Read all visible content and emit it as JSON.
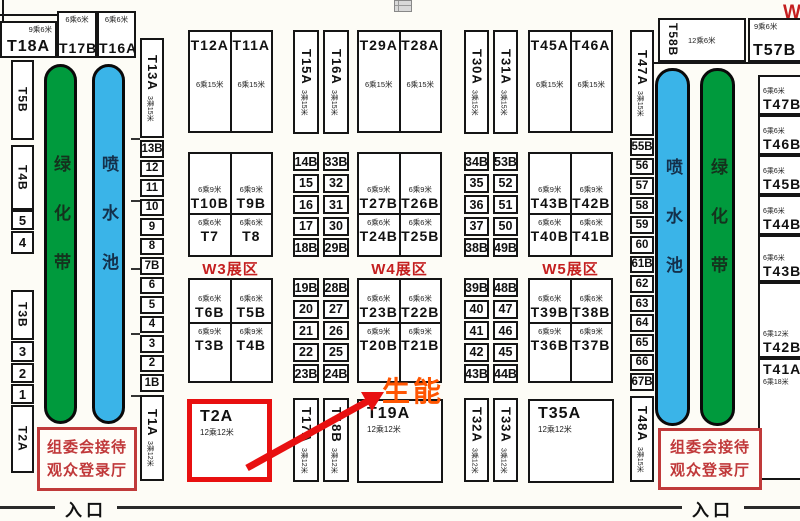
{
  "entrance": "入口",
  "green_belt_label": "绿化带",
  "fountain_label": "喷水池",
  "reception": {
    "line1": "组委会接待",
    "line2": "观众登录厅"
  },
  "annotation": {
    "text": "生能"
  },
  "zone_labels": {
    "w3": "W3展区",
    "w4": "W4展区",
    "w5": "W5展区",
    "w_cut": "W"
  },
  "colors": {
    "green_belt": "#009a3d",
    "fountain_blue": "#3ab4e8",
    "highlight_red": "#e81010",
    "zone_label_red": "#c41f1f",
    "reception_red": "#c03a3a",
    "annotation_orange": "#ff5500"
  },
  "top_left": {
    "t18a": {
      "name": "T18A",
      "size": "9乘6米"
    },
    "t17b": {
      "name": "T17B",
      "size": "6乘6米"
    },
    "t16a": {
      "name": "T16A",
      "size": "6乘6米"
    }
  },
  "left_wall_cells": [
    "T5B",
    "T4B",
    "5",
    "4",
    "T3B",
    "3",
    "2",
    "1",
    "T2A"
  ],
  "inner_left_cells": [
    "13B",
    "12",
    "11",
    "10",
    "9",
    "8",
    "7B",
    "6",
    "5",
    "4",
    "3",
    "2",
    "1B"
  ],
  "inner_right_cells": [
    "55B",
    "56",
    "57",
    "58",
    "59",
    "60",
    "61B",
    "62",
    "63",
    "64",
    "65",
    "66",
    "67B"
  ],
  "strips": {
    "t13a": {
      "name": "T13A",
      "size": "3乘15米"
    },
    "t1a": {
      "name": "T1A",
      "size": "3乘12米"
    },
    "t47a": {
      "name": "T47A",
      "size": "3乘15米"
    },
    "t48a": {
      "name": "T48A",
      "size": "3乘15米"
    },
    "t15a": {
      "name": "T15A",
      "size": "3乘15米"
    },
    "t16a": {
      "name": "T16A",
      "size": "3乘15米"
    },
    "t30a": {
      "name": "T30A",
      "size": "3乘15米"
    },
    "t31a": {
      "name": "T31A",
      "size": "3乘15米"
    },
    "t17a": {
      "name": "T17A",
      "size": "3乘12米"
    },
    "t18b": {
      "name": "T18B",
      "size": "3乘12米"
    },
    "t32a": {
      "name": "T32A",
      "size": "3乘12米"
    },
    "t33a": {
      "name": "T33A",
      "size": "3乘12米"
    }
  },
  "pair_boxes": {
    "w3_top": {
      "left": {
        "name": "T12A",
        "size": "6乘15米"
      },
      "right": {
        "name": "T11A",
        "size": "6乘15米"
      }
    },
    "w4_top": {
      "left": {
        "name": "T29A",
        "size": "6乘15米"
      },
      "right": {
        "name": "T28A",
        "size": "6乘15米"
      }
    },
    "w5_top": {
      "left": {
        "name": "T45A",
        "size": "6乘15米"
      },
      "right": {
        "name": "T46A",
        "size": "6乘15米"
      }
    }
  },
  "quad_boxes": {
    "w3_mid": {
      "tl": {
        "name": "T10B",
        "size": "6乘9米"
      },
      "tr": {
        "name": "T9B",
        "size": "6乘9米"
      },
      "bl": {
        "name": "T7",
        "size": "6乘6米"
      },
      "br": {
        "name": "T8",
        "size": "6乘6米"
      }
    },
    "w3_low": {
      "tl": {
        "name": "T6B",
        "size": "6乘6米"
      },
      "tr": {
        "name": "T5B",
        "size": "6乘6米"
      },
      "bl": {
        "name": "T3B",
        "size": "6乘9米"
      },
      "br": {
        "name": "T4B",
        "size": "6乘9米"
      }
    },
    "w4_mid": {
      "tl": {
        "name": "T27B",
        "size": "6乘9米"
      },
      "tr": {
        "name": "T26B",
        "size": "6乘9米"
      },
      "bl": {
        "name": "T24B",
        "size": "6乘6米"
      },
      "br": {
        "name": "T25B",
        "size": "6乘6米"
      }
    },
    "w4_low": {
      "tl": {
        "name": "T23B",
        "size": "6乘6米"
      },
      "tr": {
        "name": "T22B",
        "size": "6乘6米"
      },
      "bl": {
        "name": "T20B",
        "size": "6乘9米"
      },
      "br": {
        "name": "T21B",
        "size": "6乘9米"
      }
    },
    "w5_mid": {
      "tl": {
        "name": "T43B",
        "size": "6乘9米"
      },
      "tr": {
        "name": "T42B",
        "size": "6乘9米"
      },
      "bl": {
        "name": "T40B",
        "size": "6乘6米"
      },
      "br": {
        "name": "T41B",
        "size": "6乘6米"
      }
    },
    "w5_low": {
      "tl": {
        "name": "T39B",
        "size": "6乘6米"
      },
      "tr": {
        "name": "T38B",
        "size": "6乘6米"
      },
      "bl": {
        "name": "T36B",
        "size": "6乘9米"
      },
      "br": {
        "name": "T37B",
        "size": "6乘9米"
      }
    }
  },
  "big_booths": {
    "t2a": {
      "name": "T2A",
      "size": "12乘12米"
    },
    "t19a": {
      "name": "T19A",
      "size": "12乘12米"
    },
    "t35a": {
      "name": "T35A",
      "size": "12乘12米"
    }
  },
  "mini_columns": {
    "c14": [
      "14B",
      "15",
      "16",
      "17",
      "18B"
    ],
    "c33": [
      "33B",
      "32",
      "31",
      "30",
      "29B"
    ],
    "c19": [
      "19B",
      "20",
      "21",
      "22",
      "23B"
    ],
    "c28": [
      "28B",
      "27",
      "26",
      "25",
      "24B"
    ],
    "c34": [
      "34B",
      "35",
      "36",
      "37",
      "38B"
    ],
    "c53": [
      "53B",
      "52",
      "51",
      "50",
      "49B"
    ],
    "c39": [
      "39B",
      "40",
      "41",
      "42",
      "43B"
    ],
    "c48": [
      "48B",
      "47",
      "46",
      "45",
      "44B"
    ]
  },
  "right_zone": {
    "t58b": {
      "name": "T58B",
      "size": "12乘6米"
    },
    "t57b": {
      "name": "T57B",
      "size": "9乘6米"
    },
    "edge_cells": [
      {
        "name": "T47B",
        "size": "6乘6米"
      },
      {
        "name": "T46B",
        "size": "6乘6米"
      },
      {
        "name": "T45B",
        "size": "6乘6米"
      },
      {
        "name": "T44B",
        "size": "6乘6米"
      },
      {
        "name": "T43B",
        "size": "6乘6米"
      },
      {
        "name": "T42B",
        "size": "6乘12米"
      },
      {
        "name": "T41A",
        "size": "6乘18米"
      }
    ]
  }
}
